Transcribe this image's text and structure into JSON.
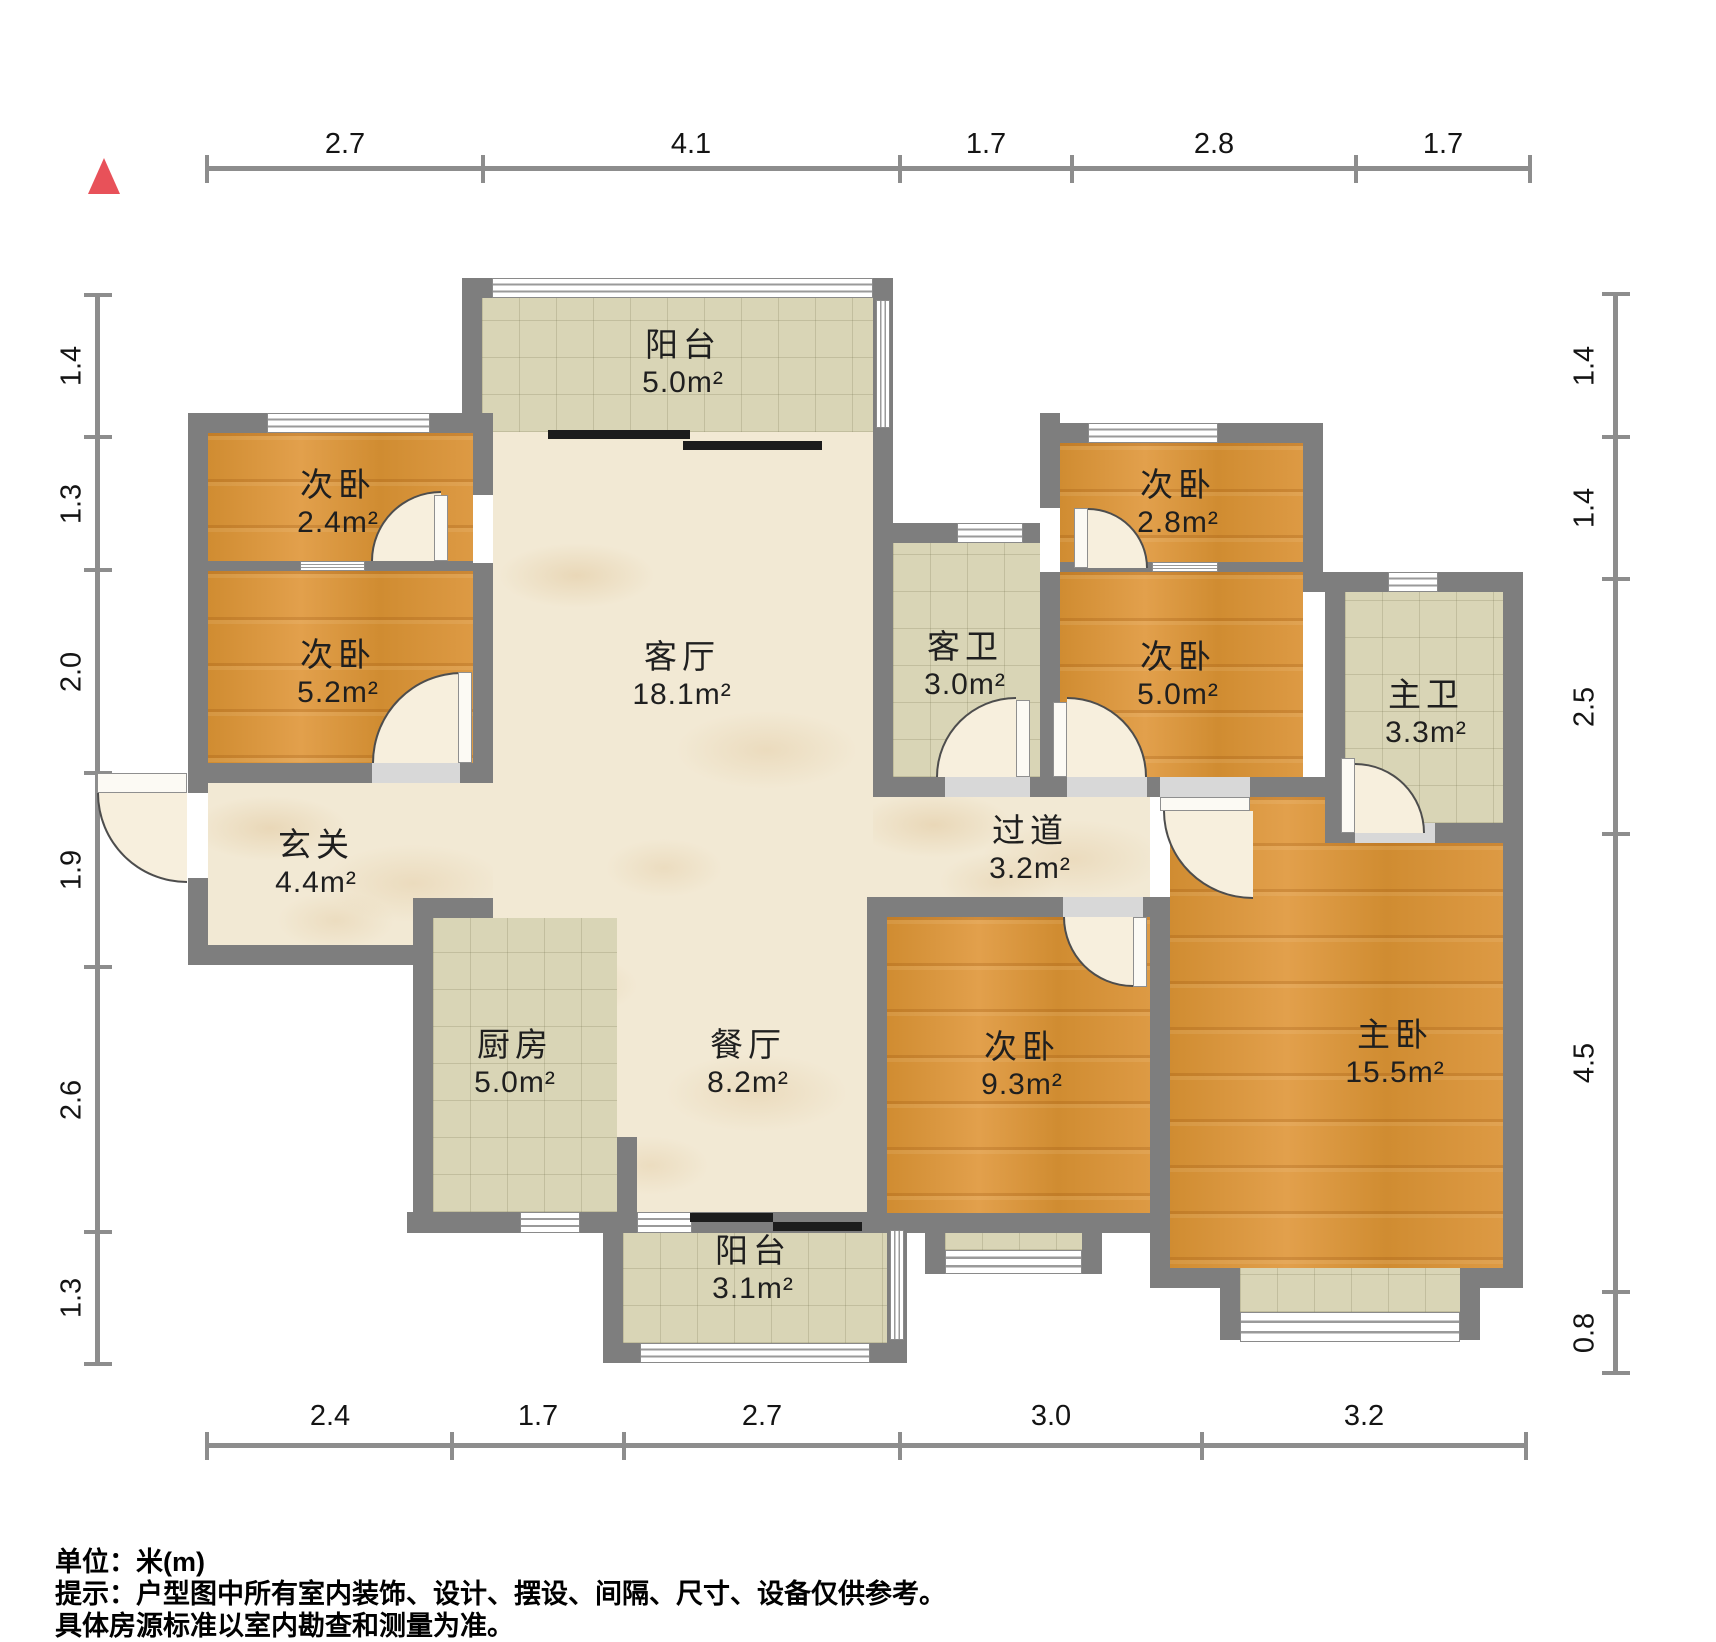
{
  "title": "户型图",
  "colors": {
    "wall": "#7e7e7e",
    "wood": "#d89440",
    "marble": "#f2e9d4",
    "tile": "#d9d5b6",
    "north_arrow": "#e85159",
    "dim_line": "#8d8d8d"
  },
  "dims": {
    "top": [
      "2.7",
      "4.1",
      "1.7",
      "2.8",
      "1.7"
    ],
    "bottom": [
      "2.4",
      "1.7",
      "2.7",
      "3.0",
      "3.2"
    ],
    "left": [
      "1.4",
      "1.3",
      "2.0",
      "1.9",
      "2.6",
      "1.3"
    ],
    "right": [
      "1.4",
      "1.4",
      "2.5",
      "4.5",
      "0.8"
    ]
  },
  "rooms": [
    {
      "name": "阳台",
      "area": "5.0m²"
    },
    {
      "name": "次卧",
      "area": "2.4m²"
    },
    {
      "name": "次卧",
      "area": "5.2m²"
    },
    {
      "name": "客厅",
      "area": "18.1m²"
    },
    {
      "name": "客卫",
      "area": "3.0m²"
    },
    {
      "name": "次卧",
      "area": "2.8m²"
    },
    {
      "name": "次卧",
      "area": "5.0m²"
    },
    {
      "name": "主卫",
      "area": "3.3m²"
    },
    {
      "name": "玄关",
      "area": "4.4m²"
    },
    {
      "name": "过道",
      "area": "3.2m²"
    },
    {
      "name": "厨房",
      "area": "5.0m²"
    },
    {
      "name": "餐厅",
      "area": "8.2m²"
    },
    {
      "name": "次卧",
      "area": "9.3m²"
    },
    {
      "name": "主卧",
      "area": "15.5m²"
    },
    {
      "name": "阳台",
      "area": "3.1m²"
    }
  ],
  "footer": {
    "unit": "单位：米(m)",
    "tip1": "提示：户型图中所有室内装饰、设计、摆设、间隔、尺寸、设备仅供参考。",
    "tip2": "具体房源标准以室内勘查和测量为准。"
  }
}
